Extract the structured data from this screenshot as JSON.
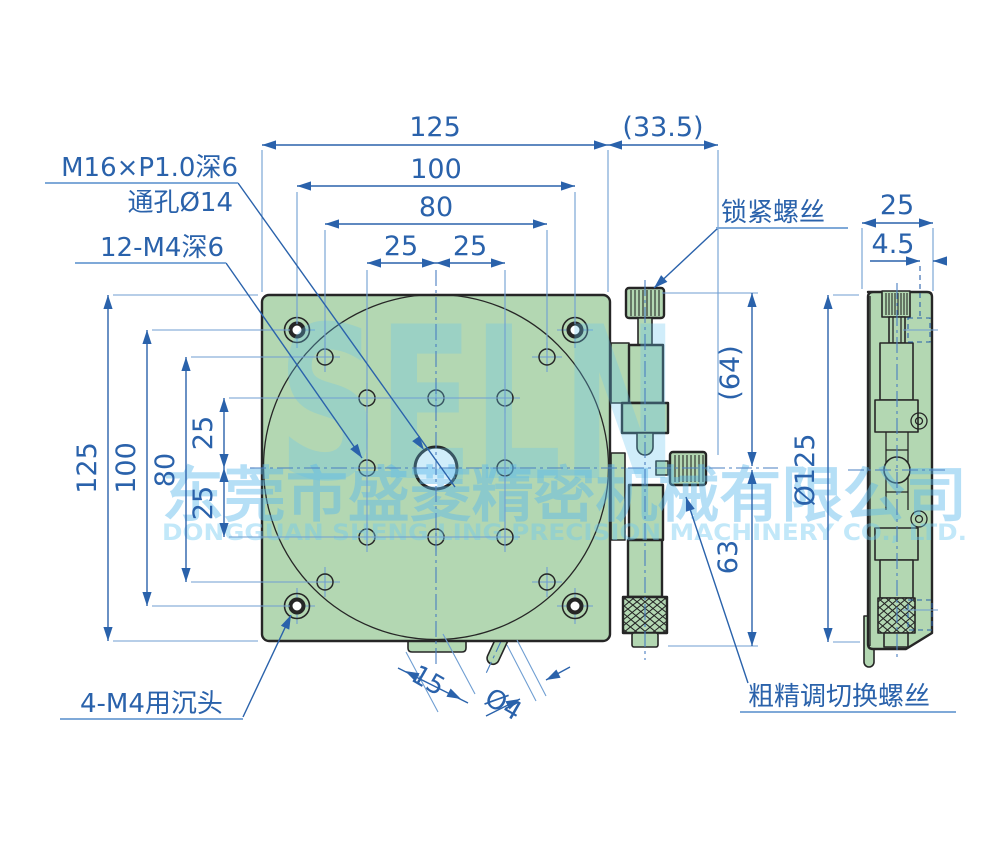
{
  "drawing": {
    "labels": {
      "thread": "M16×P1.0深6",
      "through_hole": "通孔Ø14",
      "holes12": "12-M4深6",
      "lock_screw": "锁紧螺丝",
      "counterbore": "4-M4用沉头",
      "switch_screw": "粗精调切换螺丝"
    },
    "dims": {
      "w125": "125",
      "off335": "(33.5)",
      "d100": "100",
      "d80": "80",
      "d25a": "25",
      "d25b": "25",
      "h125": "125",
      "h100": "100",
      "h80": "80",
      "h25a": "25",
      "h25b": "25",
      "r64": "(64)",
      "r63": "63",
      "s25": "25",
      "s45": "4.5",
      "sd125": "Ø125",
      "pin15": "15",
      "pind4": "Ø4"
    },
    "watermark": {
      "logo": "SELN",
      "company_cn": "东莞市盛菱精密机械有限公司",
      "company_en": "DONGGUAN SHENG LING PRECISION MACHINERY CO., LTD."
    },
    "colors": {
      "dimension_blue": "#2a62ab",
      "extension_blue": "#6f9ed2",
      "centerline_blue": "#4a7fc1",
      "plate_green": "#b3d7b2",
      "outline_dark": "#262626",
      "watermark_cyan": "#79c4e8"
    }
  }
}
